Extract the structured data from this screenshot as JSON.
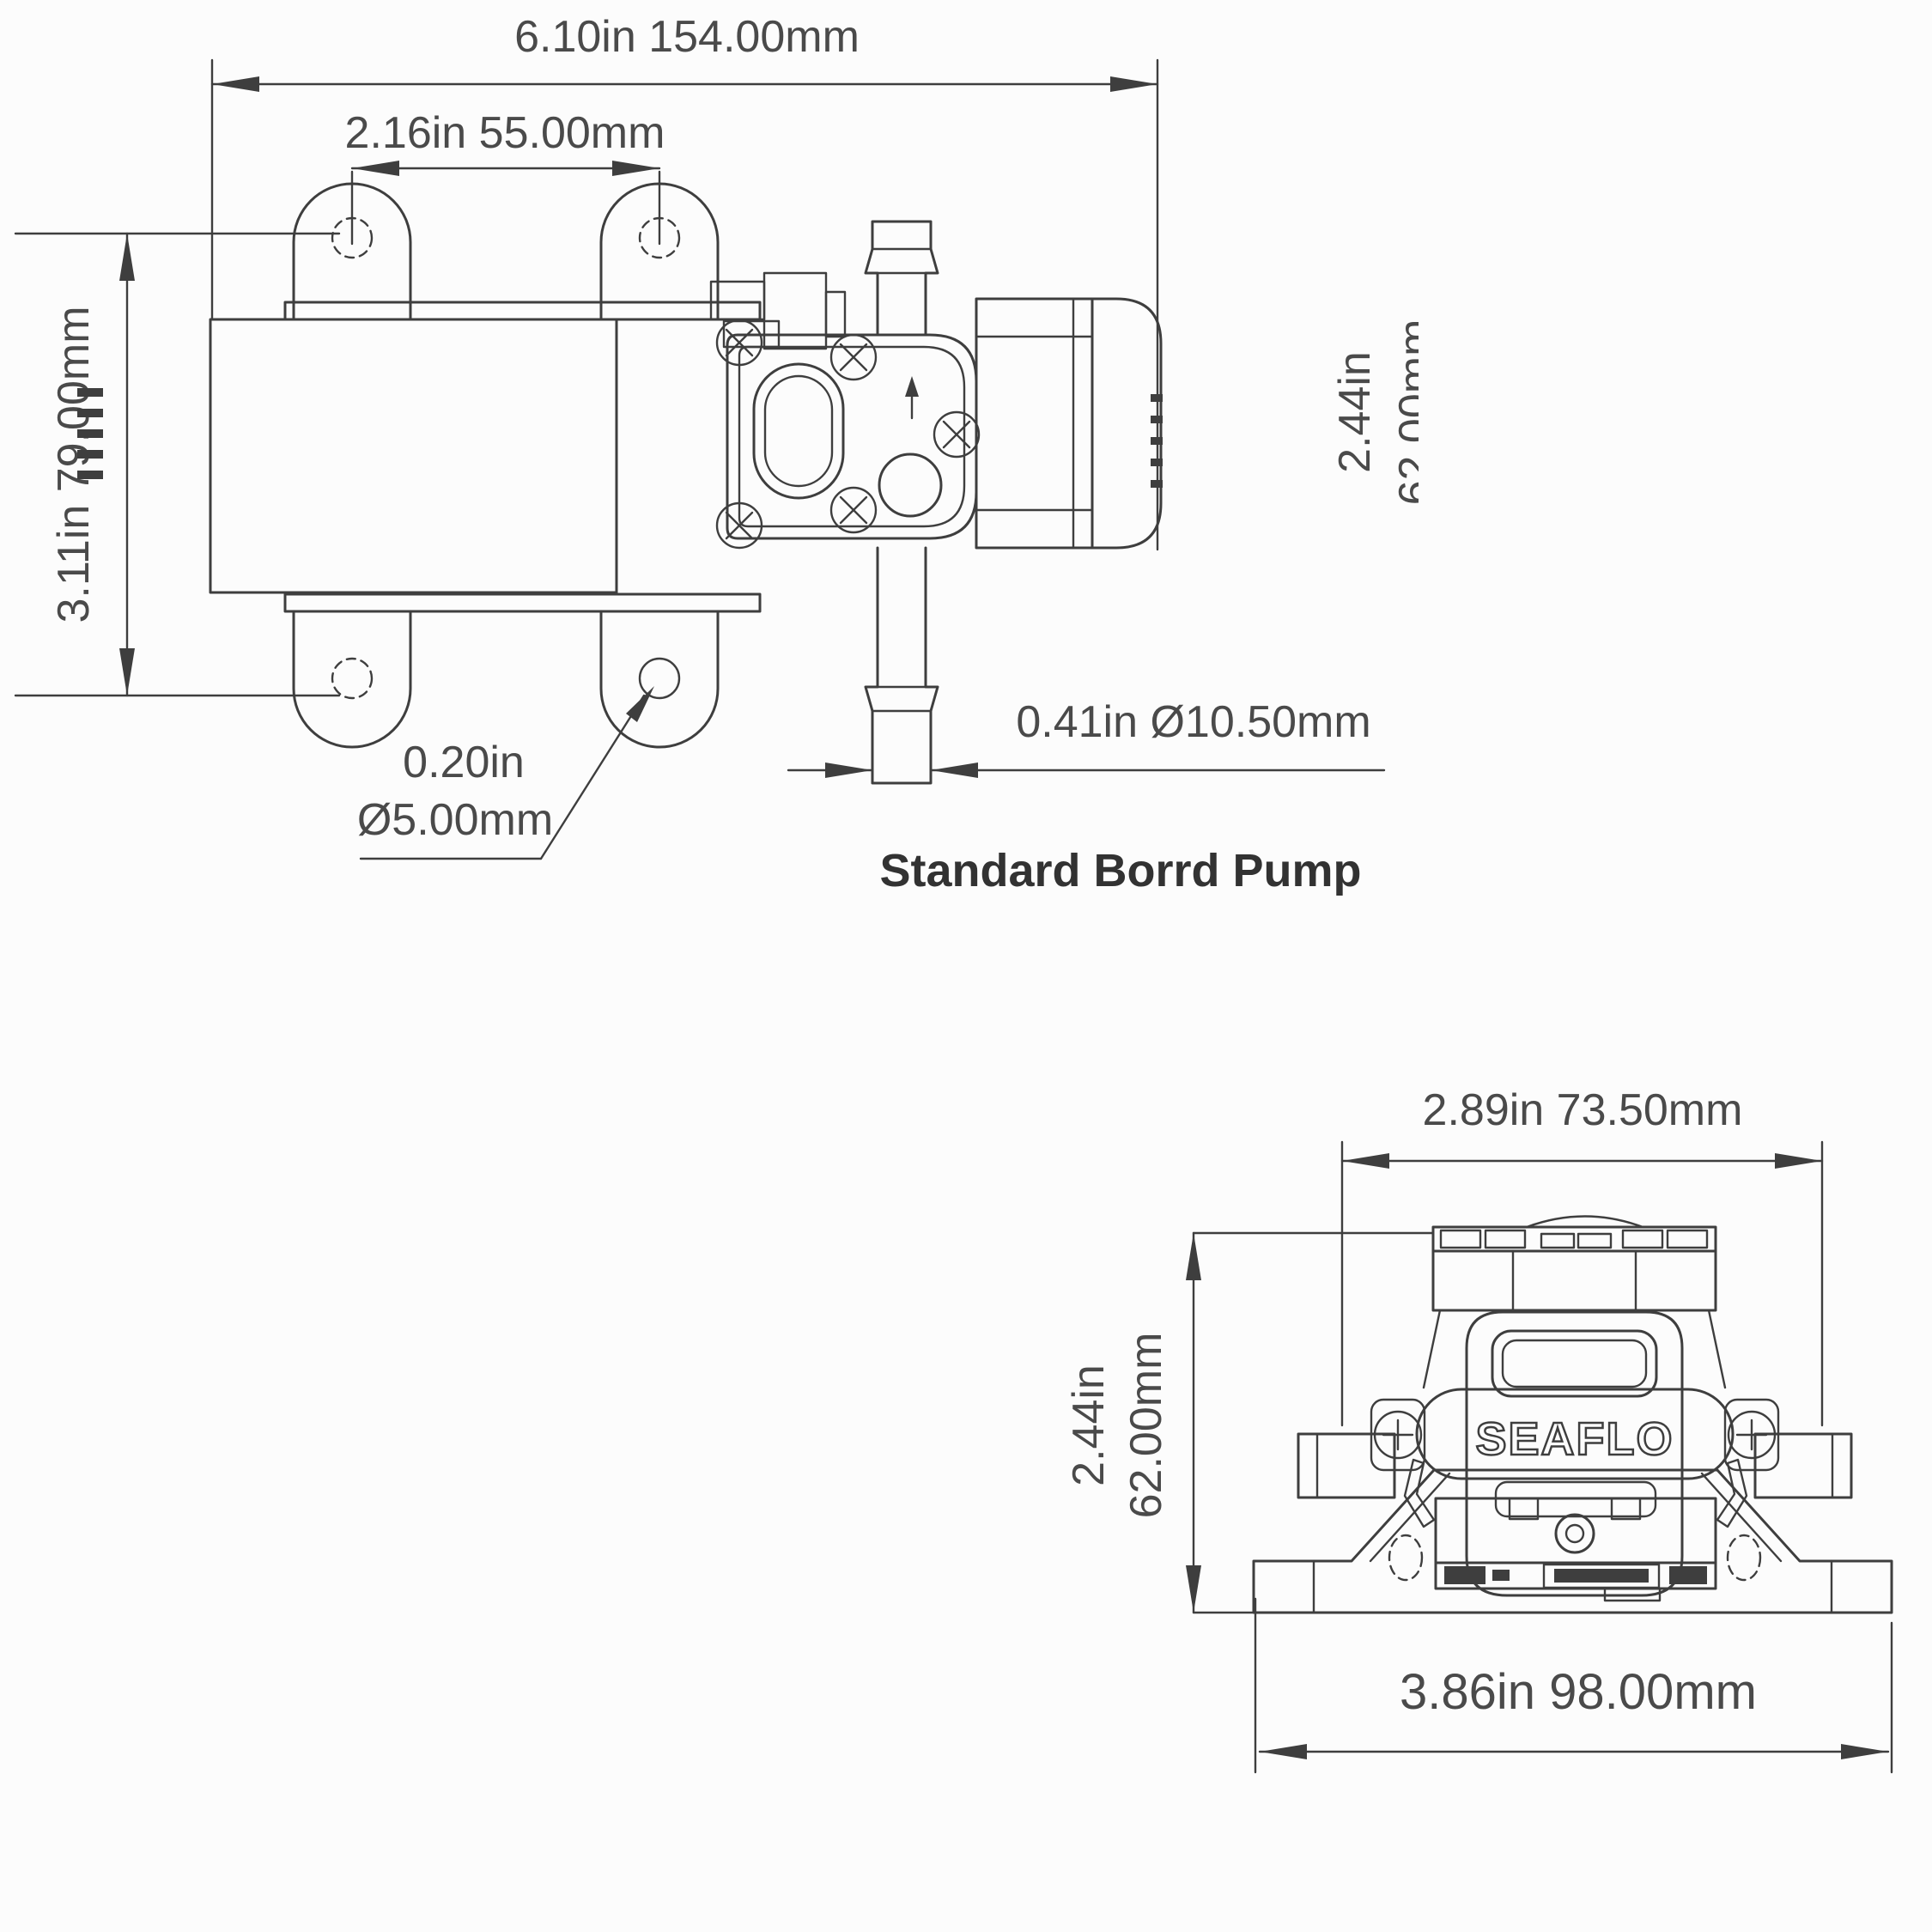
{
  "drawing": {
    "background": "#fcfcfc",
    "line_color": "#3e3e3e",
    "text_color": "#4a4a4a"
  },
  "side_view": {
    "caption": "Standard Borrd Pump",
    "dims": {
      "overall_length": "6.10in  154.00mm",
      "mount_hole_spacing": "2.16in 55.00mm",
      "mount_height": "3.11in  79.00mm",
      "body_height_in": "2.44in",
      "body_height_mm": "62.00mm",
      "mount_hole_dia_line1": "0.20in",
      "mount_hole_dia_line2": "Ø5.00mm",
      "port_dia": "0.41in  Ø10.50mm"
    }
  },
  "front_view": {
    "logo": "SEAFLO",
    "dims": {
      "body_width": "2.89in 73.50mm",
      "body_height_in": "2.44in",
      "body_height_mm": "62.00mm",
      "base_width": "3.86in 98.00mm"
    }
  }
}
